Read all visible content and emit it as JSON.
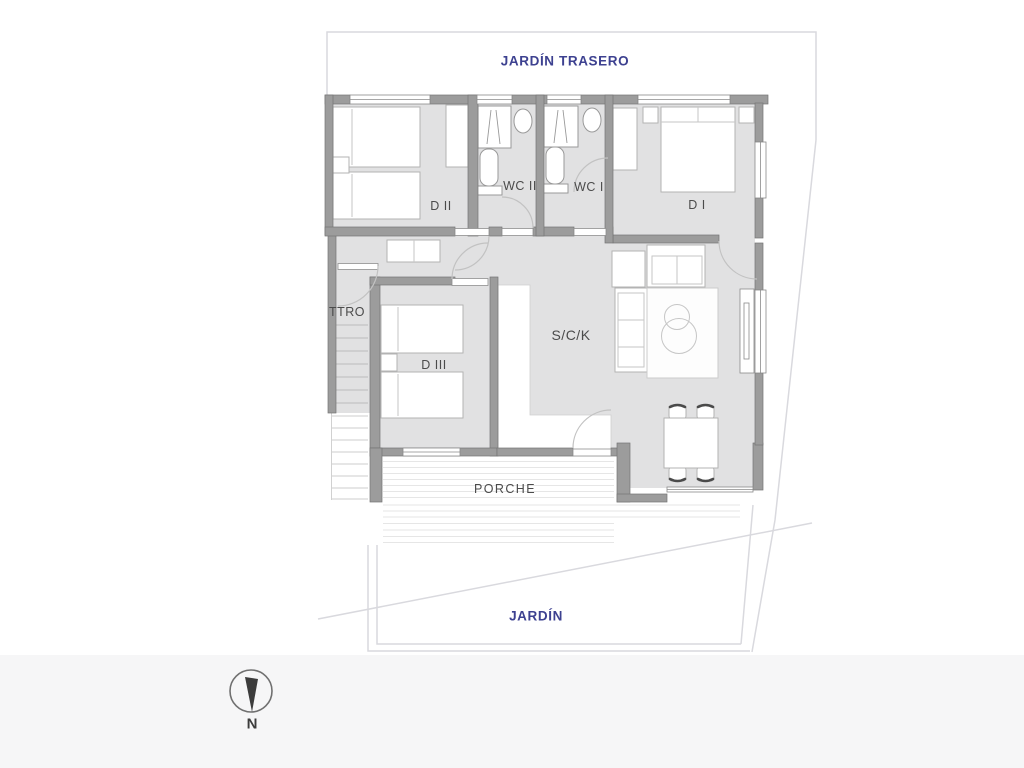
{
  "labels": {
    "garden_back": "JARDÍN TRASERO",
    "garden_front": "JARDÍN",
    "porch": "PORCHE",
    "bedroom1": "D I",
    "bedroom2": "D II",
    "bedroom3": "D III",
    "wc1": "WC I",
    "wc2": "WC II",
    "storage": "TTRO",
    "living_kitchen": "S/C/K",
    "compass_north": "N"
  },
  "colors": {
    "floor": "#e1e1e2",
    "wall": "#9c9c9c",
    "wall_edge": "#757575",
    "furniture_stroke": "#b3b3b3",
    "fixture_stroke": "#999999",
    "door_arc": "#c2c2c2",
    "deck_line": "#e6e6e6",
    "stair_line": "#bcbcbc",
    "boundary": "#d9d9de",
    "room_label": "#4b4b4b",
    "garden_label": "#3d4190",
    "compass": "#3c3c3c"
  }
}
